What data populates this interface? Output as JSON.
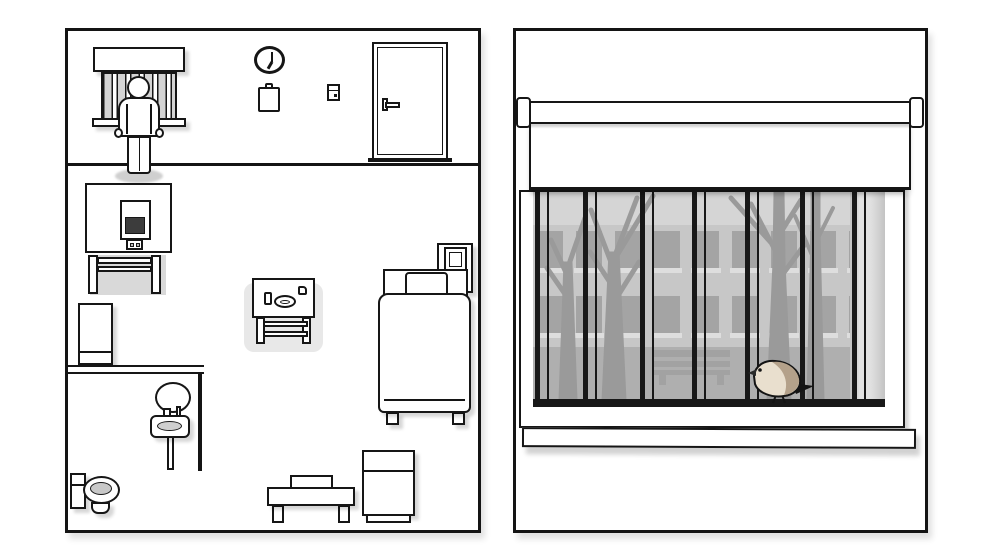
{
  "palette": {
    "outline": "#161616",
    "shadow": "#d9d9d9",
    "glass": "#d5d5d5",
    "building": "#c7c7c7",
    "building_window": "#a4a4a4",
    "ground": "#afafaf",
    "tree": "#9a9a9a",
    "bench": "#a2a2a2",
    "bars": "#181818",
    "tv_screen": "#3c3c3c",
    "highlight": "#e8e8e8"
  },
  "room_overview": {
    "clock_time": "7:00",
    "highlighted_object": "side-table",
    "objects": [
      "barred-window",
      "patient",
      "wall-clock",
      "clipboard",
      "light-switch",
      "door",
      "tv-on-table",
      "fridge",
      "bathroom-mirror",
      "sink",
      "toilet",
      "side-table",
      "bed",
      "nightstand",
      "bench",
      "cabinet"
    ]
  },
  "window_view": {
    "bars": {
      "count": 7,
      "positions": [
        2,
        50,
        107,
        159,
        212,
        267,
        319
      ],
      "thin_offset": 12
    },
    "building": {
      "rows": [
        {
          "y": 39
        },
        {
          "y": 104
        }
      ],
      "cols": 9,
      "start_x": 4,
      "win_w": 26,
      "win_h": 37,
      "gap": 13,
      "sill_h": 5
    },
    "scene_objects": [
      "roller-blind",
      "window-bars",
      "building",
      "trees",
      "park-bench",
      "pillar",
      "bird",
      "window-sill"
    ],
    "bird": {
      "body_color": "#e9dfce",
      "wing_color": "#b4a18a",
      "outline_color": "#141414",
      "beak_color": "#2a2a2a",
      "tail_color": "#141414"
    }
  }
}
